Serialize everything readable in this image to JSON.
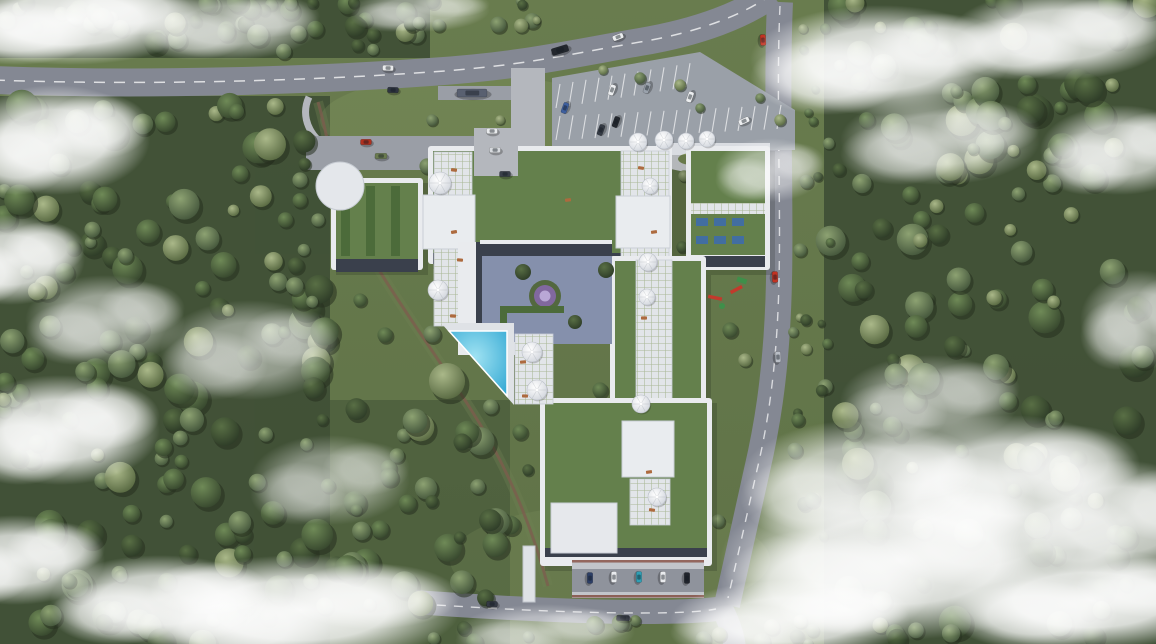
{
  "meta": {
    "description": "Aerial top-down 3D render of a residential masterplan: green-roofed building complex with dome canopies, triangular pool, central courtyard, access roads, parking lots, surrounded by forest with low clouds",
    "canvas": {
      "w": 1156,
      "h": 644
    }
  },
  "palette": {
    "grass_base": "#66794d",
    "grass_light": "#8fa368",
    "forest_floor": "#3e4e35",
    "asphalt": "#848893",
    "asphalt_light": "#9a9ea6",
    "pavement": "#b4b7bd",
    "parking_surface": "#9aa0a8",
    "building_white": "#e9ebee",
    "building_shadow": "#b9bec8",
    "facade_dark": "#3a404c",
    "roof_green": "#64804c",
    "planter_green": "#4c6b3a",
    "promenade_tile": "#e2e5e9",
    "courtyard_paving": "#8590ac",
    "pool_deck": "#dfe2e6",
    "pool_water": "#3db4dc",
    "dome_white": "#f4f5f7",
    "trail_brown": "#7d5c4e",
    "marking_white": "#e8e9eb",
    "playground_red": "#c23a2c",
    "playground_green": "#3f8f4a",
    "solar_blue": "#3d6bb0",
    "trim_brown": "#7e463a",
    "hedge_green": "#4c6b3a",
    "mandala_violet": "#8a68b0",
    "cloud_white": "#ffffff"
  },
  "scene": {
    "forest_regions": [
      {
        "x": 0,
        "y": 0,
        "w": 430,
        "h": 54,
        "n": 44,
        "rmin": 5,
        "rmax": 12
      },
      {
        "x": 0,
        "y": 98,
        "w": 328,
        "h": 546,
        "n": 155,
        "rmin": 6,
        "rmax": 17
      },
      {
        "x": 826,
        "y": 0,
        "w": 330,
        "h": 644,
        "n": 155,
        "rmin": 6,
        "rmax": 17
      },
      {
        "x": 788,
        "y": 20,
        "w": 44,
        "h": 580,
        "n": 22,
        "rmin": 4,
        "rmax": 8
      },
      {
        "x": 330,
        "y": 388,
        "w": 185,
        "h": 230,
        "n": 34,
        "rmin": 6,
        "rmax": 15
      },
      {
        "x": 430,
        "y": 618,
        "w": 300,
        "h": 26,
        "n": 10,
        "rmin": 5,
        "rmax": 9
      },
      {
        "x": 398,
        "y": 0,
        "w": 170,
        "h": 30,
        "n": 10,
        "rmin": 4,
        "rmax": 9
      },
      {
        "x": 730,
        "y": 620,
        "w": 120,
        "h": 24,
        "n": 6,
        "rmin": 5,
        "rmax": 9
      }
    ],
    "feature_trees": [
      [
        427,
        166,
        8
      ],
      [
        476,
        161,
        7
      ],
      [
        505,
        206,
        7
      ],
      [
        531,
        231,
        8
      ],
      [
        575,
        164,
        7
      ],
      [
        600,
        213,
        7
      ],
      [
        610,
        242,
        7
      ],
      [
        684,
        176,
        6
      ],
      [
        682,
        247,
        6
      ],
      [
        465,
        302,
        8
      ],
      [
        432,
        334,
        9
      ],
      [
        447,
        381,
        19
      ],
      [
        415,
        421,
        13
      ],
      [
        462,
        442,
        9
      ],
      [
        520,
        432,
        8
      ],
      [
        560,
        432,
        9
      ],
      [
        600,
        390,
        8
      ],
      [
        688,
        392,
        9
      ],
      [
        702,
        432,
        8
      ],
      [
        643,
        532,
        8
      ],
      [
        605,
        552,
        7
      ],
      [
        678,
        547,
        8
      ],
      [
        718,
        521,
        7
      ],
      [
        562,
        482,
        7
      ],
      [
        528,
        470,
        6
      ],
      [
        595,
        333,
        6
      ],
      [
        627,
        350,
        6
      ],
      [
        660,
        355,
        7
      ],
      [
        690,
        320,
        7
      ],
      [
        730,
        330,
        8
      ],
      [
        745,
        360,
        7
      ],
      [
        800,
        250,
        7
      ],
      [
        806,
        320,
        6
      ],
      [
        798,
        420,
        7
      ],
      [
        812,
        500,
        8
      ],
      [
        780,
        120,
        6
      ],
      [
        640,
        78,
        6
      ],
      [
        680,
        85,
        6
      ],
      [
        700,
        108,
        5
      ],
      [
        760,
        98,
        5
      ],
      [
        603,
        70,
        5
      ],
      [
        548,
        163,
        6
      ],
      [
        500,
        120,
        5
      ],
      [
        432,
        120,
        6
      ],
      [
        360,
        300,
        7
      ],
      [
        385,
        335,
        8
      ],
      [
        300,
        180,
        8
      ],
      [
        318,
        220,
        7
      ]
    ],
    "clouds": [
      [
        70,
        20,
        130,
        45,
        0.95
      ],
      [
        230,
        25,
        90,
        35,
        0.6
      ],
      [
        420,
        10,
        70,
        22,
        0.5
      ],
      [
        55,
        140,
        95,
        55,
        0.9
      ],
      [
        10,
        260,
        75,
        45,
        0.85
      ],
      [
        105,
        320,
        80,
        45,
        0.55
      ],
      [
        60,
        430,
        100,
        55,
        0.9
      ],
      [
        15,
        560,
        90,
        45,
        0.85
      ],
      [
        250,
        350,
        90,
        50,
        0.5
      ],
      [
        330,
        480,
        80,
        45,
        0.45
      ],
      [
        300,
        610,
        160,
        55,
        0.95
      ],
      [
        160,
        600,
        110,
        45,
        0.85
      ],
      [
        545,
        632,
        90,
        28,
        0.5
      ],
      [
        880,
        60,
        130,
        55,
        0.9
      ],
      [
        1060,
        35,
        110,
        45,
        0.85
      ],
      [
        1120,
        150,
        80,
        45,
        0.75
      ],
      [
        940,
        140,
        100,
        45,
        0.6
      ],
      [
        770,
        170,
        55,
        32,
        0.5
      ],
      [
        930,
        400,
        90,
        45,
        0.5
      ],
      [
        1010,
        480,
        130,
        65,
        0.85
      ],
      [
        900,
        560,
        180,
        80,
        0.95
      ],
      [
        1090,
        600,
        140,
        50,
        0.95
      ],
      [
        790,
        620,
        120,
        40,
        0.85
      ],
      [
        1140,
        320,
        60,
        50,
        0.55
      ],
      [
        860,
        480,
        120,
        60,
        0.7
      ],
      [
        1120,
        520,
        100,
        60,
        0.8
      ]
    ],
    "cars": [
      {
        "x": 388,
        "y": 68,
        "a": 2,
        "c": "#e8eaec"
      },
      {
        "x": 393,
        "y": 90,
        "a": 2,
        "c": "#2e3440"
      },
      {
        "x": 560,
        "y": 50,
        "a": -17,
        "c": "#23272e",
        "len": 17,
        "w": 7
      },
      {
        "x": 618,
        "y": 37,
        "a": -21,
        "c": "#eceef0"
      },
      {
        "x": 472,
        "y": 93,
        "a": 0,
        "c": "#596070",
        "len": 30,
        "w": 8
      },
      {
        "x": 366,
        "y": 142,
        "a": 0,
        "c": "#b0301f"
      },
      {
        "x": 381,
        "y": 156,
        "a": 0,
        "c": "#6a7a4f",
        "len": 12
      },
      {
        "x": 492,
        "y": 131,
        "a": 0,
        "c": "#e8eaec"
      },
      {
        "x": 495,
        "y": 150,
        "a": 0,
        "c": "#d7dade"
      },
      {
        "x": 505,
        "y": 174,
        "a": 0,
        "c": "#3a404a"
      },
      {
        "x": 565,
        "y": 108,
        "a": -70,
        "c": "#3e5f9e"
      },
      {
        "x": 612,
        "y": 90,
        "a": -70,
        "c": "#eceef0"
      },
      {
        "x": 647,
        "y": 88,
        "a": -70,
        "c": "#9aa2ac"
      },
      {
        "x": 690,
        "y": 97,
        "a": -70,
        "c": "#eceef0"
      },
      {
        "x": 601,
        "y": 130,
        "a": -70,
        "c": "#343a44"
      },
      {
        "x": 616,
        "y": 122,
        "a": -70,
        "c": "#23272e"
      },
      {
        "x": 744,
        "y": 121,
        "a": -25,
        "c": "#eceef0"
      },
      {
        "x": 763,
        "y": 40,
        "a": 87,
        "c": "#c23222"
      },
      {
        "x": 775,
        "y": 277,
        "a": 88,
        "c": "#c23222"
      },
      {
        "x": 778,
        "y": 357,
        "a": 88,
        "c": "#b9bec6"
      },
      {
        "x": 623,
        "y": 618,
        "a": 2,
        "c": "#2c313b",
        "len": 13
      },
      {
        "x": 492,
        "y": 604,
        "a": 2,
        "c": "#343944"
      },
      {
        "x": 590,
        "y": 578,
        "a": 90,
        "c": "#2c3e66"
      },
      {
        "x": 614,
        "y": 577,
        "a": 90,
        "c": "#e9ebee"
      },
      {
        "x": 639,
        "y": 577,
        "a": 90,
        "c": "#2e9fb5"
      },
      {
        "x": 663,
        "y": 577,
        "a": 90,
        "c": "#e9ebee"
      },
      {
        "x": 687,
        "y": 578,
        "a": 90,
        "c": "#20242c"
      }
    ],
    "domes": [
      [
        440,
        183,
        11
      ],
      [
        438,
        290,
        10
      ],
      [
        638,
        142,
        9
      ],
      [
        664,
        140,
        9
      ],
      [
        686,
        141,
        8
      ],
      [
        707,
        139,
        8
      ],
      [
        650,
        186,
        8
      ],
      [
        648,
        262,
        9
      ],
      [
        647,
        297,
        8
      ],
      [
        532,
        352,
        10
      ],
      [
        537,
        390,
        10
      ],
      [
        641,
        404,
        9
      ],
      [
        657,
        497,
        9
      ]
    ],
    "loungers": [
      [
        454,
        170
      ],
      [
        454,
        232
      ],
      [
        453,
        316
      ],
      [
        641,
        168
      ],
      [
        654,
        232
      ],
      [
        644,
        318
      ],
      [
        649,
        472
      ],
      [
        523,
        362
      ],
      [
        525,
        396
      ],
      [
        652,
        510
      ],
      [
        568,
        200
      ],
      [
        460,
        260
      ]
    ],
    "parking_bays": {
      "row_top": {
        "x0": 560,
        "x1": 694,
        "step": 13,
        "y": 84,
        "slope": -0.16,
        "len": 24,
        "dx": -4
      },
      "row_mid": {
        "x0": 560,
        "x1": 784,
        "step": 13,
        "y": 116,
        "slope": -0.05,
        "len": 24,
        "dx": -4
      }
    }
  }
}
